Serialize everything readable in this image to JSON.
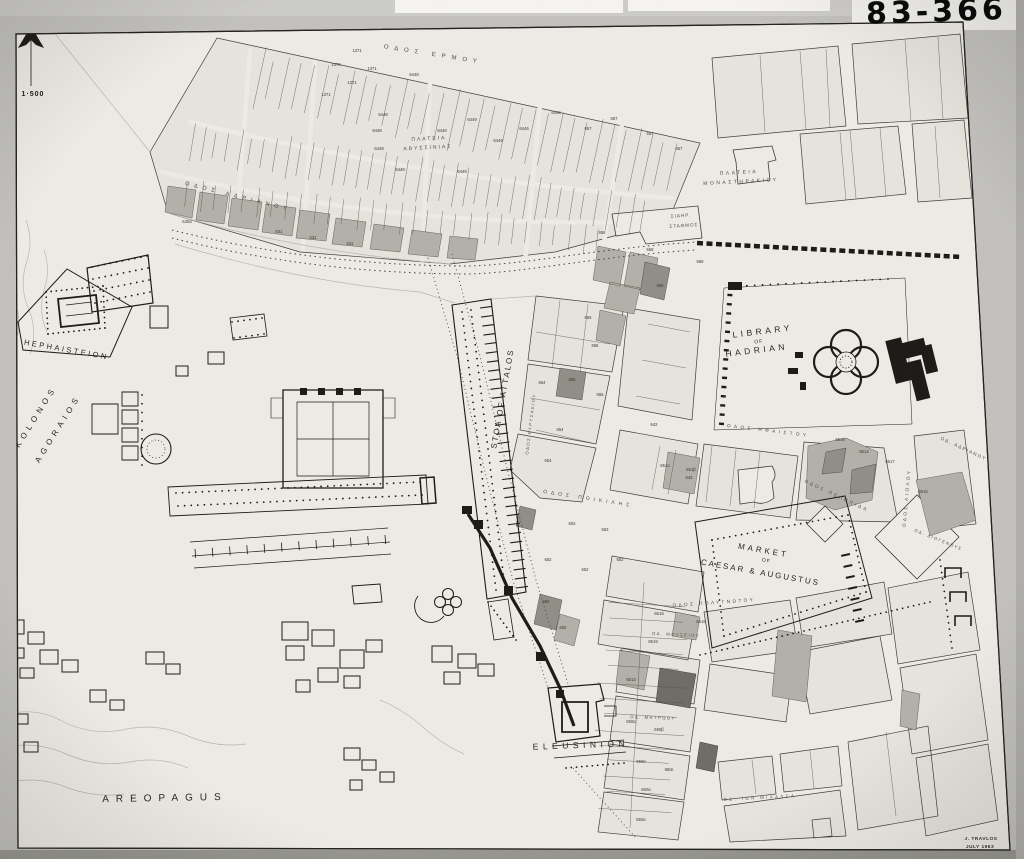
{
  "photo": {
    "catalog_number": "83-366"
  },
  "map": {
    "scale": "1·500",
    "palette": {
      "paper": "#edebe5",
      "blocks": "#e6e4dd",
      "ink": "#1b1a17",
      "shade": "#b2b0a8",
      "shade_dark": "#908e86",
      "shade_darkest": "#6e6c64",
      "photo_bg": "#c2c1be"
    },
    "labels": [
      {
        "t": "HEPHAISTEION",
        "x": 66,
        "y": 352,
        "r": 10,
        "s": 7.5,
        "ls": 2.5,
        "c": "site"
      },
      {
        "t": "KOLONOS",
        "x": 38,
        "y": 418,
        "r": -58,
        "s": 8,
        "ls": 4.5,
        "c": "site"
      },
      {
        "t": "AGORAIOS",
        "x": 60,
        "y": 430,
        "r": -58,
        "s": 8,
        "ls": 4.5,
        "c": "site"
      },
      {
        "t": "AREOPAGUS",
        "x": 165,
        "y": 801,
        "r": -1,
        "s": 10,
        "ls": 7,
        "c": "site"
      },
      {
        "t": "LIBRARY",
        "x": 763,
        "y": 334,
        "r": -7,
        "s": 8.5,
        "ls": 3.5,
        "c": "site"
      },
      {
        "t": "OF",
        "x": 759,
        "y": 343,
        "r": -7,
        "s": 5,
        "ls": 1,
        "c": "site"
      },
      {
        "t": "HADRIAN",
        "x": 757,
        "y": 353,
        "r": -7,
        "s": 8.5,
        "ls": 3.5,
        "c": "site"
      },
      {
        "t": "MARKET",
        "x": 763,
        "y": 553,
        "r": 10,
        "s": 8,
        "ls": 3,
        "c": "site"
      },
      {
        "t": "OF",
        "x": 766,
        "y": 562,
        "r": 10,
        "s": 5,
        "ls": 1,
        "c": "site"
      },
      {
        "t": "CAESAR & AUGUSTUS",
        "x": 760,
        "y": 575,
        "r": 10,
        "s": 8,
        "ls": 2,
        "c": "site"
      },
      {
        "t": "STOA OF ATTALOS",
        "x": 505,
        "y": 399,
        "r": -80,
        "s": 8,
        "ls": 2,
        "c": "site"
      },
      {
        "t": "ELEUSINION",
        "x": 581,
        "y": 748,
        "r": -2,
        "s": 8.5,
        "ls": 4.5,
        "c": "site"
      },
      {
        "t": "ΟΔΟΣ ΕΡΜΟΥ",
        "x": 433,
        "y": 56,
        "r": 9,
        "s": 6,
        "ls": 6,
        "c": "street"
      },
      {
        "t": "ΠΛΑΤΕΙΑ",
        "x": 429,
        "y": 140,
        "r": -3,
        "s": 5,
        "ls": 2,
        "c": "street"
      },
      {
        "t": "ΑΒΥΣΣΙΝΙΑΣ",
        "x": 428,
        "y": 149,
        "r": -3,
        "s": 5,
        "ls": 2,
        "c": "street"
      },
      {
        "t": "ΠΛΑΤΕΙΑ",
        "x": 739,
        "y": 174,
        "r": -3,
        "s": 5,
        "ls": 2.5,
        "c": "street"
      },
      {
        "t": "ΜΟΝΑΣΤΗΡΑΚΙΟΥ",
        "x": 741,
        "y": 183,
        "r": -3,
        "s": 5,
        "ls": 2.5,
        "c": "street"
      },
      {
        "t": "ΣΙΔΗΡ.",
        "x": 681,
        "y": 217,
        "r": -4,
        "s": 4.6,
        "ls": 1,
        "c": "street"
      },
      {
        "t": "ΣΤΑΘΜΟΣ",
        "x": 684,
        "y": 227,
        "r": -4,
        "s": 4.6,
        "ls": 1,
        "c": "street"
      },
      {
        "t": "ΟΔΟΣ ΑΔΡΙΑΝΟΥ",
        "x": 238,
        "y": 198,
        "r": 14,
        "s": 5.5,
        "ls": 5,
        "c": "street"
      },
      {
        "t": "ΟΔΟΣ ΠΟΙΚΙΛΗΣ",
        "x": 588,
        "y": 500,
        "r": 9,
        "s": 5,
        "ls": 4,
        "c": "street"
      },
      {
        "t": "ΟΔΟΣ ΗΦΑΙΣΤΟΥ",
        "x": 768,
        "y": 432,
        "r": 7,
        "s": 4.6,
        "ls": 3.5,
        "c": "street"
      },
      {
        "t": "ΟΔΟΣ ΠΕΛΟΠΙΔΑ",
        "x": 836,
        "y": 497,
        "r": 25,
        "s": 4.6,
        "ls": 2.5,
        "c": "street"
      },
      {
        "t": "ΟΔ. ΑΔΡΙΑΝΟΥ",
        "x": 963,
        "y": 450,
        "r": 25,
        "s": 4.6,
        "ls": 1.5,
        "c": "street"
      },
      {
        "t": "ΟΔΟΣ ΑΙΟΛΟΥ",
        "x": 908,
        "y": 498,
        "r": -85,
        "s": 4.6,
        "ls": 2.5,
        "c": "street"
      },
      {
        "t": "ΟΔΟΣ ΠΟΛΥΓΝΩΤΟΥ",
        "x": 714,
        "y": 604,
        "r": -4,
        "s": 4.6,
        "ls": 2.5,
        "c": "street"
      },
      {
        "t": "ΟΔ. ΜΟΥΣΕΙΟΥ",
        "x": 676,
        "y": 636,
        "r": 3,
        "s": 4.2,
        "ls": 1.5,
        "c": "street"
      },
      {
        "t": "ΟΔ. ΜΗΤΡΩΟΥ",
        "x": 653,
        "y": 719,
        "r": 2,
        "s": 4.2,
        "ls": 1.5,
        "c": "street"
      },
      {
        "t": "ΟΔ. ΙΩΝ ΜΙΧΑΛΕΑ",
        "x": 760,
        "y": 799,
        "r": -3,
        "s": 4.2,
        "ls": 2.5,
        "c": "street"
      },
      {
        "t": "ΟΔΟΣ ΕΥΡΥΣΑΚΙΟΥ",
        "x": 532,
        "y": 424,
        "r": -83,
        "s": 4.2,
        "ls": 1.5,
        "c": "street"
      },
      {
        "t": "ΟΔ. ΔΙΟΓΕΝΟΥΣ",
        "x": 938,
        "y": 541,
        "r": 22,
        "s": 4.2,
        "ls": 1.5,
        "c": "street"
      },
      {
        "t": "1·500",
        "x": 33,
        "y": 96,
        "r": 0,
        "s": 7,
        "ls": 1,
        "c": "scale"
      },
      {
        "t": "J. TRAVLOS",
        "x": 981,
        "y": 840,
        "r": 0,
        "s": 4.8,
        "ls": 0.5,
        "c": "credit"
      },
      {
        "t": "JULY 1963",
        "x": 980,
        "y": 848,
        "r": 0,
        "s": 4.8,
        "ls": 0.5,
        "c": "credit"
      }
    ],
    "parcels": [
      {
        "t": "1370",
        "x": 336,
        "y": 66
      },
      {
        "t": "1371",
        "x": 357,
        "y": 52
      },
      {
        "t": "1371",
        "x": 372,
        "y": 70
      },
      {
        "t": "1371",
        "x": 352,
        "y": 84
      },
      {
        "t": "1371",
        "x": 326,
        "y": 96
      },
      {
        "t": "6448",
        "x": 414,
        "y": 76
      },
      {
        "t": "6448",
        "x": 383,
        "y": 116
      },
      {
        "t": "6448",
        "x": 377,
        "y": 132
      },
      {
        "t": "6448",
        "x": 379,
        "y": 150
      },
      {
        "t": "6448",
        "x": 400,
        "y": 171
      },
      {
        "t": "6448",
        "x": 442,
        "y": 132
      },
      {
        "t": "6449",
        "x": 472,
        "y": 121
      },
      {
        "t": "6449",
        "x": 498,
        "y": 142
      },
      {
        "t": "6449",
        "x": 462,
        "y": 173
      },
      {
        "t": "6446",
        "x": 524,
        "y": 130
      },
      {
        "t": "6446",
        "x": 556,
        "y": 114
      },
      {
        "t": "657",
        "x": 588,
        "y": 130
      },
      {
        "t": "657",
        "x": 614,
        "y": 120
      },
      {
        "t": "657",
        "x": 650,
        "y": 135
      },
      {
        "t": "657",
        "x": 679,
        "y": 150
      },
      {
        "t": "656",
        "x": 602,
        "y": 234
      },
      {
        "t": "658",
        "x": 650,
        "y": 251
      },
      {
        "t": "658",
        "x": 700,
        "y": 263
      },
      {
        "t": "656",
        "x": 660,
        "y": 287
      },
      {
        "t": "655",
        "x": 588,
        "y": 319
      },
      {
        "t": "655",
        "x": 595,
        "y": 347
      },
      {
        "t": "655",
        "x": 572,
        "y": 381
      },
      {
        "t": "655",
        "x": 600,
        "y": 396
      },
      {
        "t": "654",
        "x": 542,
        "y": 384
      },
      {
        "t": "654",
        "x": 560,
        "y": 431
      },
      {
        "t": "654",
        "x": 548,
        "y": 462
      },
      {
        "t": "653",
        "x": 572,
        "y": 525
      },
      {
        "t": "653",
        "x": 605,
        "y": 531
      },
      {
        "t": "652",
        "x": 548,
        "y": 561
      },
      {
        "t": "652",
        "x": 585,
        "y": 571
      },
      {
        "t": "652",
        "x": 620,
        "y": 561
      },
      {
        "t": "651α",
        "x": 665,
        "y": 467
      },
      {
        "t": "651β",
        "x": 691,
        "y": 471
      },
      {
        "t": "642",
        "x": 654,
        "y": 426
      },
      {
        "t": "643",
        "x": 689,
        "y": 479
      },
      {
        "t": "631",
        "x": 279,
        "y": 233
      },
      {
        "t": "631",
        "x": 313,
        "y": 239
      },
      {
        "t": "631",
        "x": 350,
        "y": 245
      },
      {
        "t": "630α",
        "x": 187,
        "y": 223
      },
      {
        "t": "6516",
        "x": 840,
        "y": 441
      },
      {
        "t": "6514",
        "x": 864,
        "y": 453
      },
      {
        "t": "6517",
        "x": 890,
        "y": 463
      },
      {
        "t": "6515",
        "x": 923,
        "y": 493
      },
      {
        "t": "6518",
        "x": 659,
        "y": 615
      },
      {
        "t": "6516",
        "x": 701,
        "y": 623
      },
      {
        "t": "6513",
        "x": 631,
        "y": 681
      },
      {
        "t": "650α",
        "x": 631,
        "y": 723
      },
      {
        "t": "650β",
        "x": 659,
        "y": 731
      },
      {
        "t": "650α",
        "x": 641,
        "y": 763
      },
      {
        "t": "650ε",
        "x": 669,
        "y": 771
      },
      {
        "t": "650α",
        "x": 646,
        "y": 791
      },
      {
        "t": "650α",
        "x": 641,
        "y": 821
      },
      {
        "t": "682",
        "x": 546,
        "y": 603
      },
      {
        "t": "682",
        "x": 563,
        "y": 629
      },
      {
        "t": "6519",
        "x": 653,
        "y": 643
      }
    ]
  }
}
